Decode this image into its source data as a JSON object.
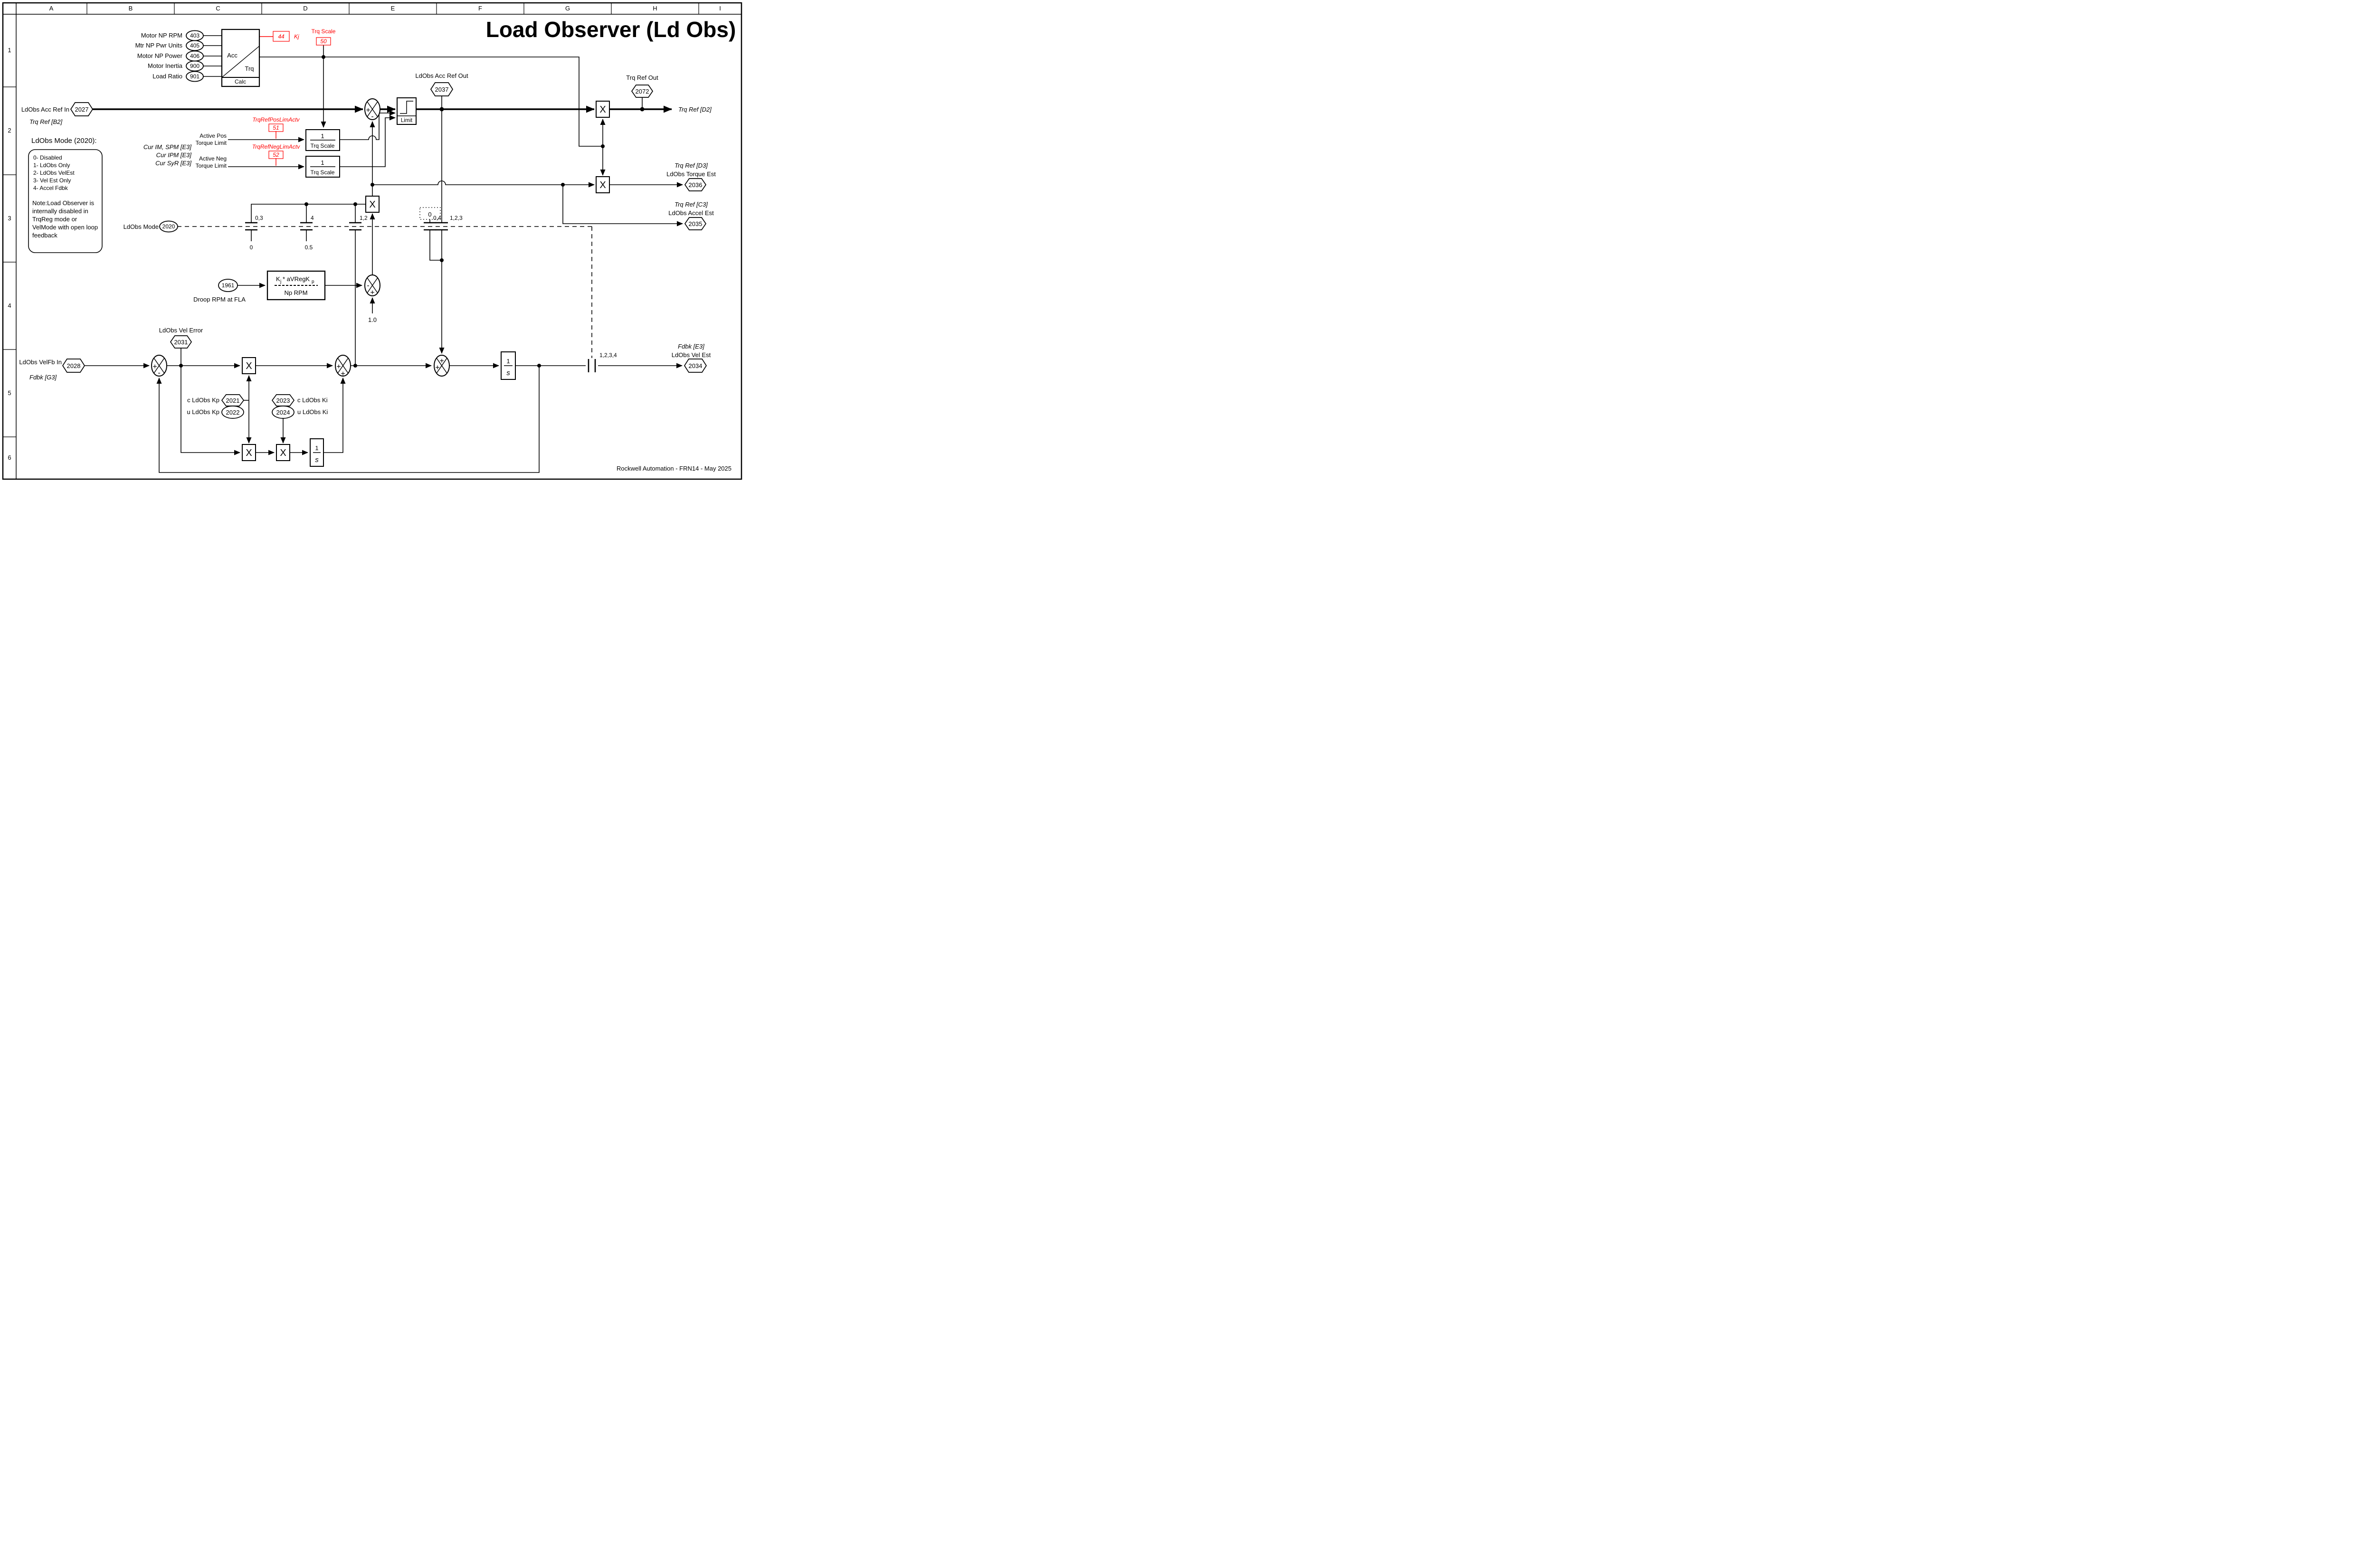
{
  "sheet": {
    "title": "Load Observer (Ld Obs)",
    "footer": "Rockwell Automation - FRN14 - May 2025",
    "columns": [
      "A",
      "B",
      "C",
      "D",
      "E",
      "F",
      "G",
      "H",
      "I"
    ],
    "rows": [
      "1",
      "2",
      "3",
      "4",
      "5",
      "6"
    ]
  },
  "glyphs": {
    "x": "X",
    "plus": "+",
    "minus": "-",
    "one": "1",
    "s": "s"
  },
  "calc": {
    "inputs": [
      {
        "label": "Motor NP RPM",
        "param": "403"
      },
      {
        "label": "Mtr NP Pwr Units",
        "param": "405"
      },
      {
        "label": "Motor NP Power",
        "param": "406"
      },
      {
        "label": "Motor Inertia",
        "param": "900"
      },
      {
        "label": "Load Ratio",
        "param": "901"
      }
    ],
    "acc": "Acc",
    "trq": "Trq",
    "calc": "Calc",
    "kj_value": "44",
    "kj_label": "Kj",
    "trq_scale_label": "Trq Scale",
    "trq_scale_value": "50"
  },
  "main": {
    "in_label": "LdObs Acc Ref In",
    "in_param": "2027",
    "in_ref": "Trq Ref [B2]",
    "limit": "Limit",
    "acc_out_label": "LdObs Acc Ref Out",
    "acc_out_param": "2037",
    "trq_out_label": "Trq Ref Out",
    "trq_out_param": "2072",
    "out_ref": "Trq Ref [D2]"
  },
  "limits": {
    "pos_tag": "TrqRefPosLimActv",
    "pos_value": "51",
    "pos_l1": "Active Pos",
    "pos_l2": "Torque Limit",
    "neg_tag": "TrqRefNegLimActv",
    "neg_value": "52",
    "neg_l1": "Active Neg",
    "neg_l2": "Torque Limit",
    "cur": [
      "Cur IM, SPM [E3]",
      "Cur IPM [E3]",
      "Cur SyR [E3]"
    ],
    "num": "1",
    "den": "Trq Scale"
  },
  "outputs": {
    "d3": "Trq Ref [D3]",
    "torque_est": "LdObs Torque Est",
    "p2036": "2036",
    "c3": "Trq Ref [C3]",
    "accel_est": "LdObs Accel Est",
    "p2035": "2035",
    "e3": "Fdbk [E3]",
    "vel_est": "LdObs Vel Est",
    "p2034": "2034"
  },
  "mode": {
    "label": "LdObs Mode",
    "param": "2020",
    "heading": "LdObs Mode (2020):",
    "options": [
      "0- Disabled",
      "1- LdObs Only",
      "2- LdObs VelEst",
      "3- Vel Est Only",
      "4- Accel Fdbk"
    ],
    "note": [
      "Note:Load Observer is",
      "internally disabled in",
      "TrqReg mode or",
      "VelMode with open loop",
      "feedback"
    ],
    "sw1": "0,3",
    "sw1_val": "0",
    "sw2": "4",
    "sw2_val": "0.5",
    "sw3": "1,2",
    "sw4": "0,4",
    "sw4_src": "0",
    "sw5": "1,2,3",
    "sw6": "1,2,3,4"
  },
  "droop": {
    "param": "1961",
    "label": "Droop RPM at FLA",
    "num_k": "K",
    "num_k_sub": "j",
    "num_mid": " * aVRegK",
    "num_p_sub": "p",
    "den": "Np RPM",
    "unity": "1.0"
  },
  "vel": {
    "in_label": "LdObs VelFb In",
    "in_param": "2028",
    "in_ref": "Fdbk [G3]",
    "err_label": "LdObs Vel Error",
    "err_param": "2031",
    "kp_c": "c LdObs Kp",
    "p2021": "2021",
    "kp_u": "u LdObs Kp",
    "p2022": "2022",
    "ki_c": "c LdObs Ki",
    "p2023": "2023",
    "ki_u": "u LdObs Ki",
    "p2024": "2024"
  }
}
